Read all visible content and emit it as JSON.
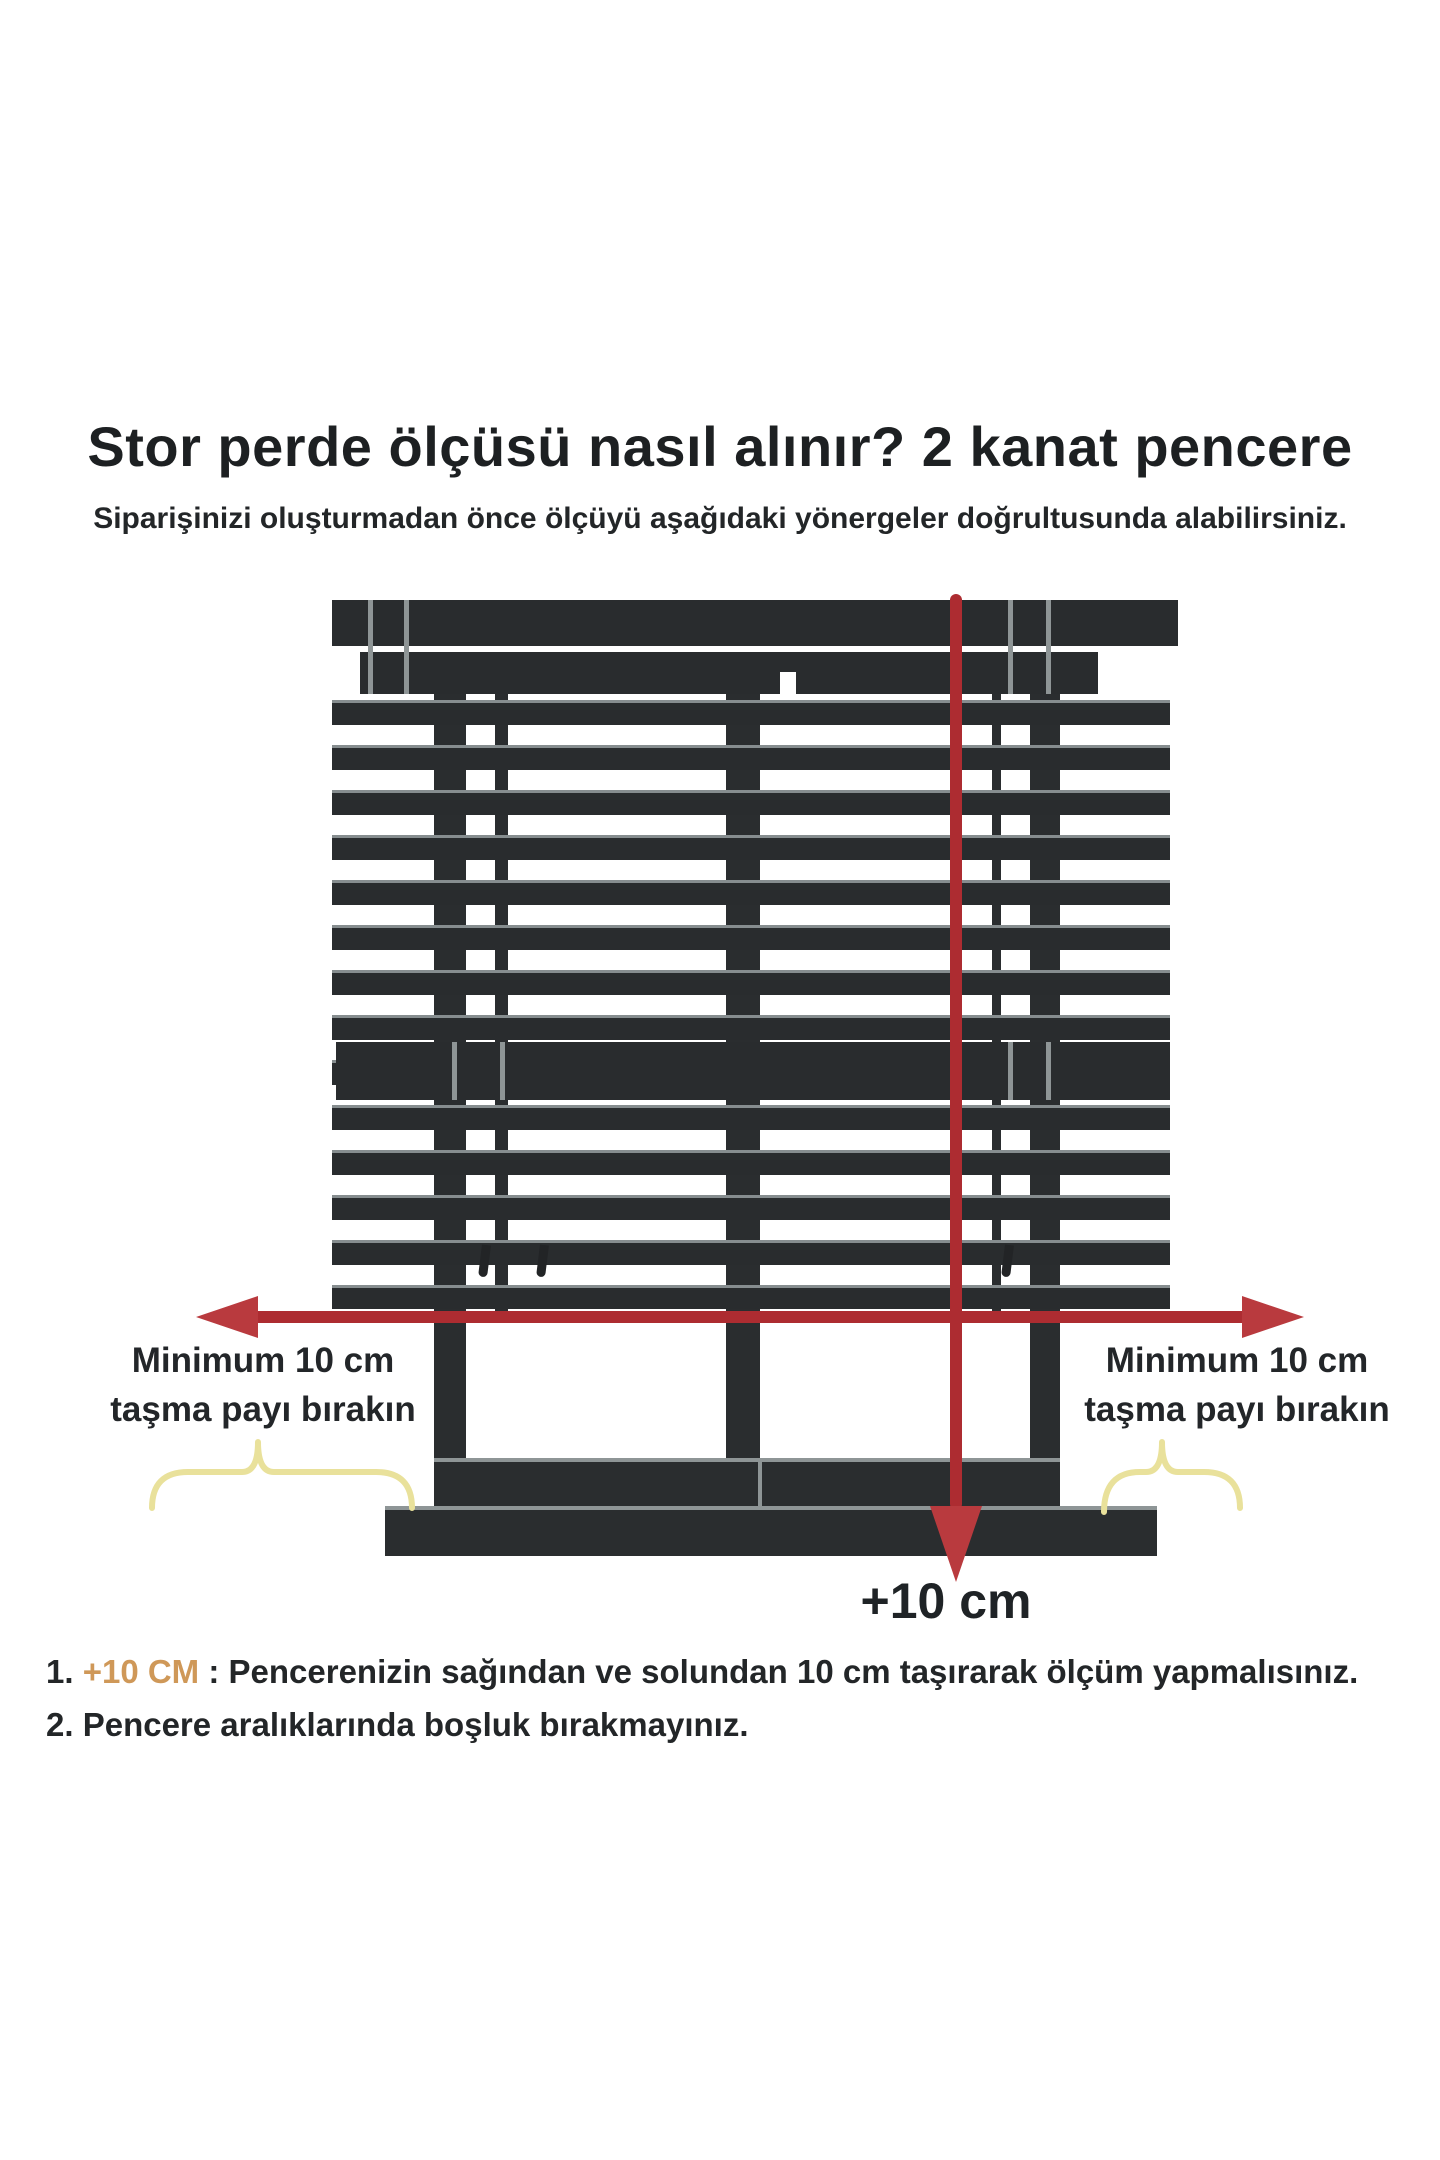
{
  "header": {
    "title": "Stor perde ölçüsü nasıl alınır? 2 kanat pencere",
    "subtitle": "Siparişinizi oluşturmadan önce ölçüyü aşağıdaki yönergeler doğrultusunda alabilirsiniz."
  },
  "diagram": {
    "left_label": {
      "line1": "Minimum 10 cm",
      "line2": "taşma payı bırakın"
    },
    "right_label": {
      "line1": "Minimum 10 cm",
      "line2": "taşma payı bırakın"
    },
    "bottom_arrow_label": "+10 cm",
    "colors": {
      "frame_dark": "#2a2d2f",
      "slat_highlight": "#868d8f",
      "arrow_red": "#ad2c31",
      "arrowhead_red": "#b93a3e",
      "brace_yellow": "#e9e19b"
    }
  },
  "instructions": {
    "highlight_color": "#cf9858",
    "items": [
      {
        "number": "1.",
        "highlight": "+10 CM",
        "text": " : Pencerenizin sağından ve solundan 10 cm taşırarak ölçüm yapmalısınız."
      },
      {
        "number": "2.",
        "highlight": "",
        "text": " Pencere aralıklarında boşluk bırakmayınız."
      }
    ]
  }
}
